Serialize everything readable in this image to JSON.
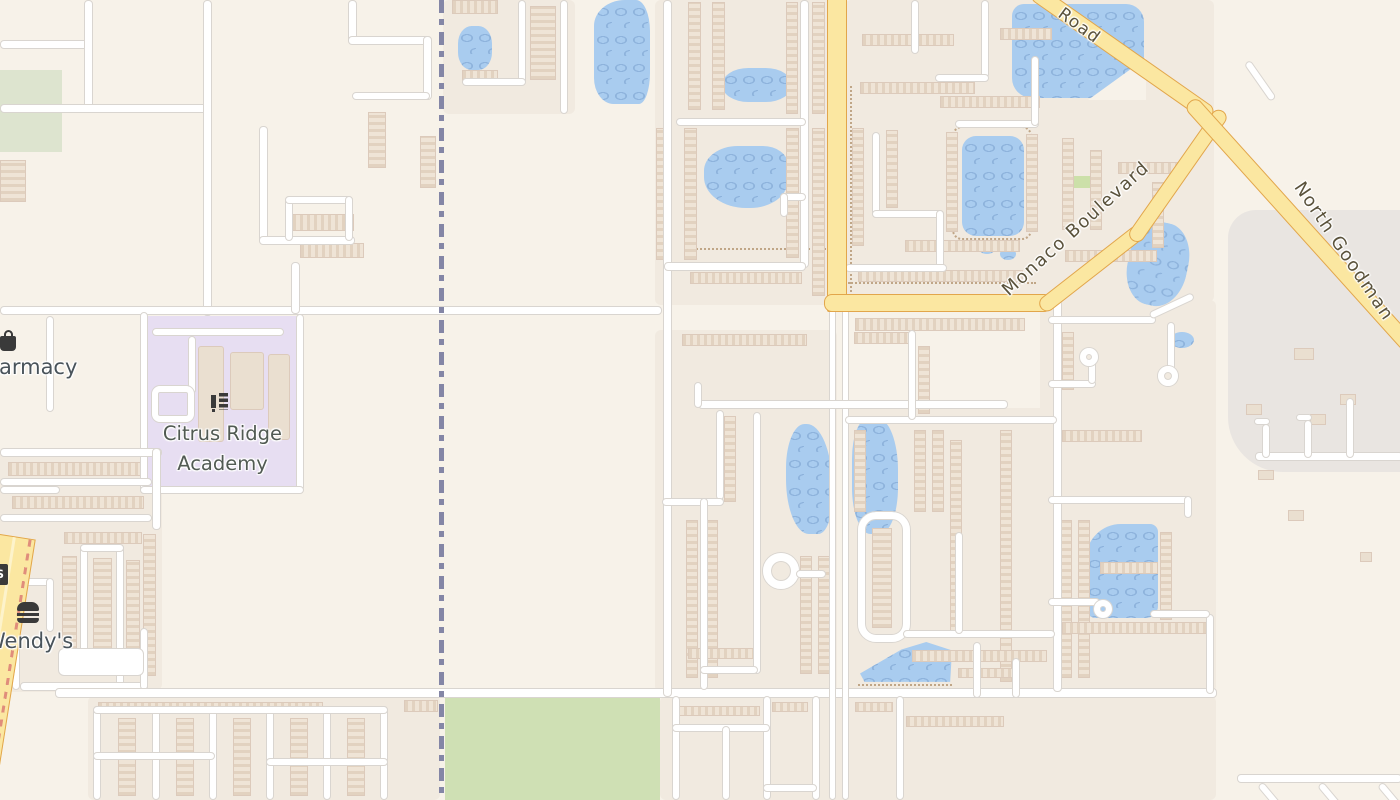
{
  "map": {
    "type": "street-map",
    "poi": {
      "pharmacy_label": "Pharmacy",
      "wendys_label": "Wendy's",
      "school_label_line1": "Citrus Ridge",
      "school_label_line2": "Academy"
    },
    "roads": {
      "label_road": "Road",
      "label_monaco": "Monaco Boulevard",
      "label_north_goodman": "North Goodman"
    },
    "icons": {
      "pharmacy": "shopping-bag-icon",
      "wendys": "burger-icon",
      "school": "school-icon",
      "edge_partial": "partial-poi-icon"
    },
    "colors": {
      "background": "#f7f2e9",
      "residential": "#f1eae0",
      "road_fill": "#ffffff",
      "road_casing": "#d9d5d0",
      "major_road_fill": "#fbe7a1",
      "major_road_casing": "#e2a64b",
      "water": "#a9ccef",
      "water_wave": "#8eb3dc",
      "park": "#cfe0b4",
      "grass_light": "#dde4cf",
      "school_area": "#e7def2",
      "boundary": "#8486a6",
      "building": "#eadfd0",
      "gray_area": "#e9e5e1",
      "poi_label_text": "#49535a",
      "road_label_text": "#5a523b"
    }
  }
}
